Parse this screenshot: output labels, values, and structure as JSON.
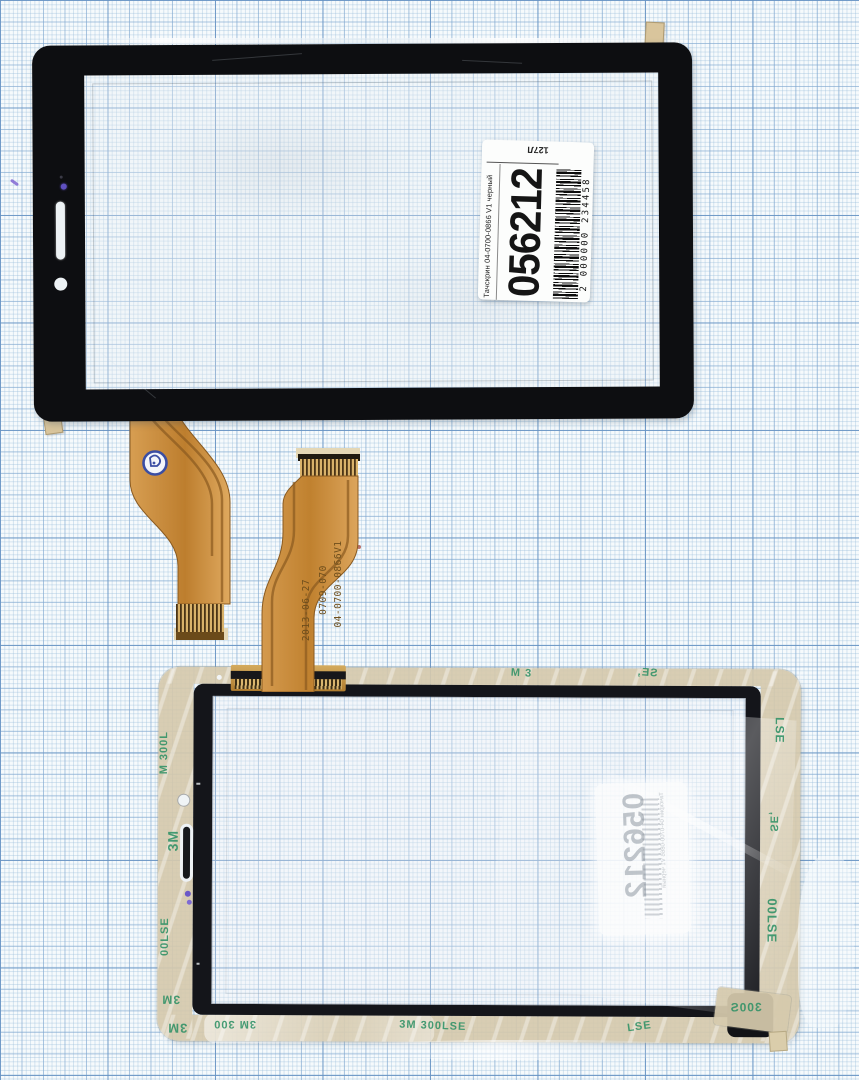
{
  "scene": {
    "description": "Touchscreen digitizer front and back views on millimeter graph paper"
  },
  "front_label": {
    "product_line": "Тачскрин 04-0700-0866 V1 черный",
    "stock_number": "056212",
    "barcode_text": "2 000000 234458",
    "corner_mark": "127Л"
  },
  "back_label": {
    "stock_number": "056212",
    "product_line": "Тачскрин 04-0700-0866 V1 черный"
  },
  "flex_markings": {
    "part_number": "04-0700-0866V1",
    "batch": "0709-070",
    "date": "2013-06-27"
  },
  "tape": {
    "full": "3M 300LSE",
    "brand": "3M",
    "code": "300LSE",
    "frag_m300l": "M 300L",
    "frag_00lse": "00LSE",
    "frag_lse": "LSE",
    "frag_se": "SE,",
    "frag_m3": "M 3",
    "frag_300s": "300S",
    "frag_3m300": "3M 300"
  },
  "colors": {
    "panel_black": "#0d0e11",
    "flex_gold": "#c88a3e",
    "tape_film": "#d5c9ac",
    "tape_print_green": "#2f9166",
    "stamp_blue": "#3b4ea3",
    "paper_background": "#f6fafc"
  }
}
